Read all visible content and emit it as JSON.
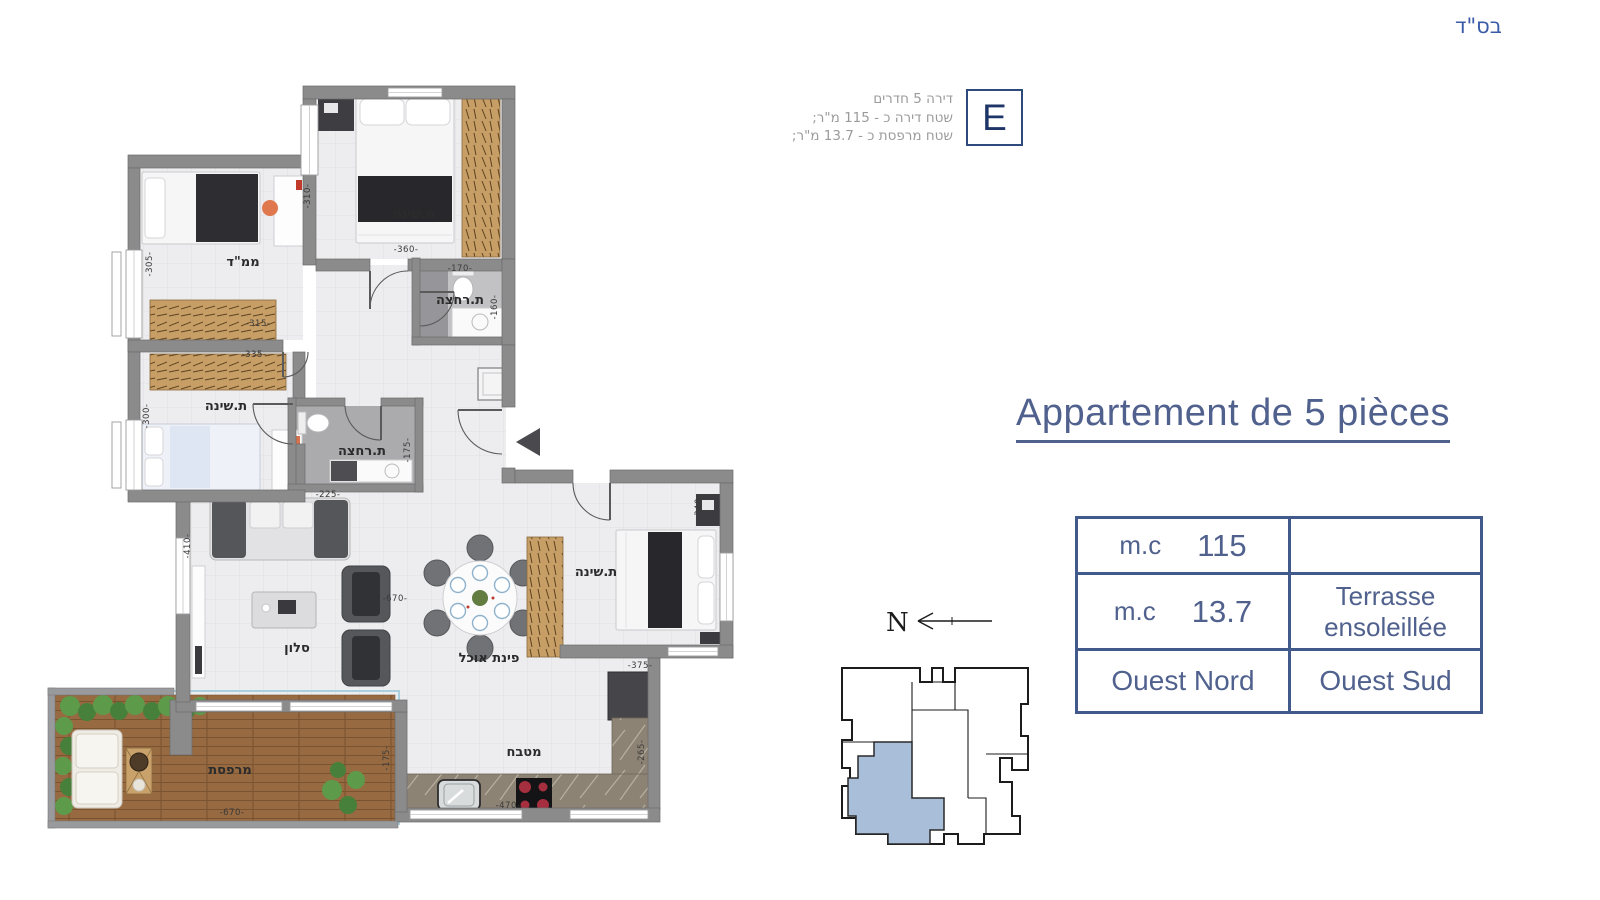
{
  "page": {
    "bsd": "בס\"ד"
  },
  "unit_info": {
    "letter": "E",
    "line1": "דירה 5 חדרים",
    "line2": "שטח דירה כ - 115 מ\"ר;",
    "line3": "שטח מרפסת כ - 13.7 מ\"ר;"
  },
  "title": {
    "text": "Appartement de 5 pièces"
  },
  "spec_table": {
    "rows": [
      {
        "unit": "m.c",
        "value": "115",
        "desc": ""
      },
      {
        "unit": "m.c",
        "value": "13.7",
        "desc_line1": "Terrasse",
        "desc_line2": "ensoleillée"
      },
      {
        "left": "Ouest Nord",
        "right": "Ouest Sud"
      }
    ]
  },
  "compass": {
    "north_label": "N"
  },
  "colors": {
    "accent_blue": "#50618e",
    "table_border": "#42598c",
    "bsd_blue": "#3a5ca8",
    "e_border": "#2e4a7c",
    "e_letter": "#1e3667",
    "info_gray": "#9b9b9b",
    "wall_gray": "#8b8b8b",
    "keyplan_unit_fill": "#a9bed8",
    "deck_wood": "#976a41"
  },
  "floor_plan": {
    "room_labels": [
      {
        "text": "ת.שינה",
        "x": 414,
        "y": 218
      },
      {
        "text": "ממ\"ד",
        "x": 243,
        "y": 266
      },
      {
        "text": "ת.שינה",
        "x": 226,
        "y": 410
      },
      {
        "text": "ת.רחצה",
        "x": 460,
        "y": 304
      },
      {
        "text": "ת.רחצה",
        "x": 362,
        "y": 455
      },
      {
        "text": "סלון",
        "x": 297,
        "y": 652
      },
      {
        "text": "פינת אוכל",
        "x": 489,
        "y": 662
      },
      {
        "text": "ת.שינה",
        "x": 596,
        "y": 576
      },
      {
        "text": "מטבח",
        "x": 524,
        "y": 756
      },
      {
        "text": "מרפסת",
        "x": 230,
        "y": 774
      }
    ],
    "dimensions": [
      {
        "text": "-360-",
        "x": 406,
        "y": 252,
        "rot": 0
      },
      {
        "text": "-310-",
        "x": 310,
        "y": 196,
        "rot": -90
      },
      {
        "text": "-315-",
        "x": 258,
        "y": 326,
        "rot": 0
      },
      {
        "text": "-305-",
        "x": 152,
        "y": 264,
        "rot": -90
      },
      {
        "text": "-335-",
        "x": 254,
        "y": 357,
        "rot": 0
      },
      {
        "text": "-300-",
        "x": 149,
        "y": 416,
        "rot": -90
      },
      {
        "text": "-170-",
        "x": 460,
        "y": 271,
        "rot": 0
      },
      {
        "text": "-160-",
        "x": 497,
        "y": 307,
        "rot": -90
      },
      {
        "text": "-225-",
        "x": 328,
        "y": 497,
        "rot": 0
      },
      {
        "text": "-175-",
        "x": 410,
        "y": 450,
        "rot": -90
      },
      {
        "text": "-670-",
        "x": 395,
        "y": 601,
        "rot": 0
      },
      {
        "text": "-410-",
        "x": 190,
        "y": 546,
        "rot": -90
      },
      {
        "text": "-375-",
        "x": 640,
        "y": 668,
        "rot": 0
      },
      {
        "text": "-340-",
        "x": 701,
        "y": 507,
        "rot": -90
      },
      {
        "text": "-470-",
        "x": 508,
        "y": 808,
        "rot": 0
      },
      {
        "text": "-265-",
        "x": 644,
        "y": 752,
        "rot": -90
      },
      {
        "text": "-670-",
        "x": 232,
        "y": 815,
        "rot": 0
      },
      {
        "text": "-175-",
        "x": 389,
        "y": 758,
        "rot": -90
      }
    ]
  }
}
